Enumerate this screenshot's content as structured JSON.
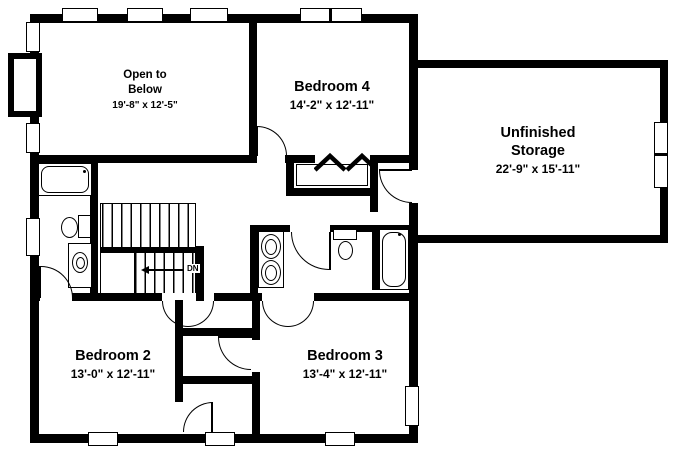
{
  "plan_title": "Second floor plan",
  "rooms": {
    "open_to_below": {
      "name": "Open to\nBelow",
      "dims": "19'-8\" x 12'-5\""
    },
    "bedroom4": {
      "name": "Bedroom 4",
      "dims": "14'-2\" x 12'-11\""
    },
    "unfinished_storage": {
      "name": "Unfinished\nStorage",
      "dims": "22'-9\" x 15'-11\""
    },
    "bedroom2": {
      "name": "Bedroom 2",
      "dims": "13'-0\" x 12'-11\""
    },
    "bedroom3": {
      "name": "Bedroom 3",
      "dims": "13'-4\" x 12'-11\""
    }
  },
  "stairs": {
    "direction_label": "DN"
  },
  "colors": {
    "wall": "#000000",
    "background": "#ffffff"
  }
}
